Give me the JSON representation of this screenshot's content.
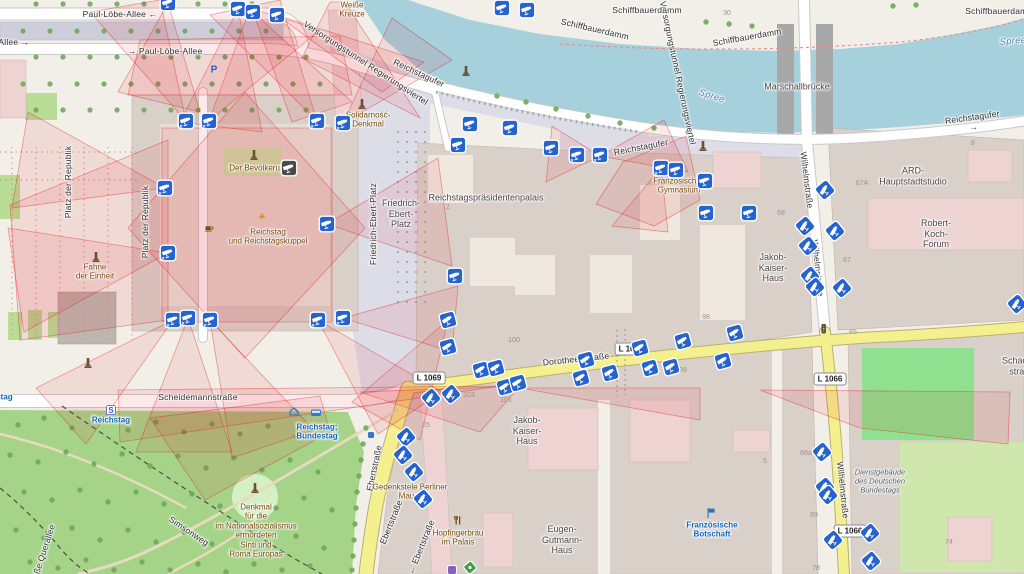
{
  "colors": {
    "camera_blue": "#2563cf",
    "viewshed_red": "#e31a1c",
    "water": "#a6d0dc",
    "park_green": "#a5d488",
    "building_tan": "#d9d0c9",
    "building_pink": "#eed3d3",
    "road_yellow": "#f4f08e",
    "pedestrian": "#dddde8"
  },
  "shields": [
    {
      "t": "L 1069",
      "x": 429,
      "y": 378
    },
    {
      "t": "L 1066",
      "x": 631,
      "y": 349
    },
    {
      "t": "L 1066",
      "x": 830,
      "y": 379
    },
    {
      "t": "L 1066",
      "x": 850,
      "y": 531
    }
  ],
  "labels": [
    {
      "t": "Paul-Löbe-Allee  ←",
      "x": 120,
      "y": 14,
      "cls": "st"
    },
    {
      "t": "Allee  →",
      "x": 14,
      "y": 42,
      "cls": "st"
    },
    {
      "t": "→  Paul-Löbe-Allee",
      "x": 165,
      "y": 51,
      "cls": "st"
    },
    {
      "t": "Versorgungstunnel Regierungsviertel",
      "x": 366,
      "y": 63,
      "rot": 33,
      "cls": "st"
    },
    {
      "t": "Versorgungstunnel Regierungsviertel",
      "x": 678,
      "y": 73,
      "rot": 78,
      "cls": "st"
    },
    {
      "t": "Schiffbauerdamm",
      "x": 647,
      "y": 10,
      "cls": "st"
    },
    {
      "t": "Schiffbauerdamm",
      "x": 595,
      "y": 29,
      "rot": 13,
      "cls": "st"
    },
    {
      "t": "Schiffbauerdamm",
      "x": 747,
      "y": 37,
      "rot": -10,
      "cls": "st"
    },
    {
      "t": "Schiffbauerdamm",
      "x": 1000,
      "y": 11,
      "cls": "st"
    },
    {
      "t": "Reichstagufer",
      "x": 419,
      "y": 73,
      "rot": 25,
      "cls": "st"
    },
    {
      "t": "Reichstagufer",
      "x": 641,
      "y": 147,
      "rot": -11,
      "cls": "st"
    },
    {
      "t": "Reichstagufer  →",
      "x": 973,
      "y": 122,
      "rot": -8,
      "cls": "st"
    },
    {
      "t": "Marschallbrücke",
      "x": 797,
      "y": 87,
      "cls": "pl"
    },
    {
      "t": "Platz der Republik",
      "x": 68,
      "y": 182,
      "rot": -90,
      "cls": "st"
    },
    {
      "t": "Platz der Republik",
      "x": 145,
      "y": 222,
      "rot": -90,
      "cls": "st"
    },
    {
      "t": "Friedrich-Ebert-Platz",
      "x": 373,
      "y": 224,
      "rot": -90,
      "cls": "st"
    },
    {
      "t": "Scheidemannstraße",
      "x": 198,
      "y": 397,
      "cls": "st"
    },
    {
      "t": "Dorotheenstraße",
      "x": 576,
      "y": 359,
      "rot": -6,
      "cls": "st"
    },
    {
      "t": "Ebertstraße",
      "x": 374,
      "y": 468,
      "rot": -78,
      "cls": "st"
    },
    {
      "t": "Ebertstraße",
      "x": 391,
      "y": 522,
      "rot": -68,
      "cls": "st"
    },
    {
      "t": "←  Ebertstraße",
      "x": 421,
      "y": 547,
      "rot": -68,
      "cls": "st"
    },
    {
      "t": "Wilhelmstraße",
      "x": 807,
      "y": 180,
      "rot": 83,
      "cls": "st"
    },
    {
      "t": "Wilhelmstraße",
      "x": 818,
      "y": 268,
      "rot": 84,
      "cls": "st"
    },
    {
      "t": "Wilhelmstraße",
      "x": 843,
      "y": 490,
      "rot": 84,
      "cls": "st"
    },
    {
      "t": "Simsonweg",
      "x": 189,
      "y": 531,
      "rot": 34,
      "cls": "st"
    },
    {
      "t": "Große Querallee",
      "x": 42,
      "y": 556,
      "rot": -72,
      "cls": "st"
    },
    {
      "t": "Reichstagspräsidentenpalais",
      "x": 486,
      "y": 198,
      "cls": "pl"
    },
    {
      "t": "Jakob-\nKaiser-\nHaus",
      "x": 773,
      "y": 268,
      "cls": "pl"
    },
    {
      "t": "Jakob-\nKaiser-\nHaus",
      "x": 527,
      "y": 431,
      "cls": "pl"
    },
    {
      "t": "Eugen-\nGutmann-\nHaus",
      "x": 562,
      "y": 540,
      "cls": "pl"
    },
    {
      "t": "ARD-\nHauptstadtstudio",
      "x": 913,
      "y": 176,
      "cls": "pl"
    },
    {
      "t": "Robert-\nKoch-\nForum",
      "x": 936,
      "y": 234,
      "cls": "pl"
    },
    {
      "t": "Friedrich-\nEbert-\nPlatz",
      "x": 401,
      "y": 214,
      "cls": "pl"
    },
    {
      "t": "Schadow-\nstraße",
      "x": 1022,
      "y": 366,
      "cls": "pl"
    },
    {
      "t": "Weiße\nKreuze",
      "x": 352,
      "y": 10,
      "cls": "poi"
    },
    {
      "t": "Solidarność-\nDenkmal",
      "x": 368,
      "y": 120,
      "cls": "poi"
    },
    {
      "t": "Fahne\nder Einheit",
      "x": 95,
      "y": 272,
      "cls": "poi"
    },
    {
      "t": "Der Bevölkerung",
      "x": 259,
      "y": 168,
      "cls": "poi"
    },
    {
      "t": "Reichstag\nund Reichstagskuppel",
      "x": 268,
      "y": 237,
      "cls": "poi"
    },
    {
      "t": "Französisches\nGymnasium",
      "x": 679,
      "y": 186,
      "cls": "poi"
    },
    {
      "t": "Denkmal\nfür die\nim Nationalsozialismus\nermordeten\nSinti und\nRoma Europas",
      "x": 256,
      "y": 531,
      "cls": "poi"
    },
    {
      "t": "Hopfingerbräu\nim Palais",
      "x": 458,
      "y": 538,
      "cls": "poi"
    },
    {
      "t": "Gedenkstele Berliner\nMauer",
      "x": 410,
      "y": 492,
      "cls": "poi"
    },
    {
      "t": "Reichstag",
      "x": 111,
      "y": 420,
      "cls": "tr"
    },
    {
      "t": "Reichstag;\nBundestag",
      "x": 317,
      "y": 432,
      "cls": "tr"
    },
    {
      "t": "Französische\nBotschaft",
      "x": 712,
      "y": 530,
      "cls": "tr"
    },
    {
      "t": "Bundestag",
      "x": -8,
      "y": 397,
      "cls": "tr"
    },
    {
      "t": "Spree",
      "x": 712,
      "y": 96,
      "rot": 18,
      "cls": "wa"
    },
    {
      "t": "Spree",
      "x": 1013,
      "y": 41,
      "rot": -5,
      "cls": "wa"
    },
    {
      "t": "Dienstgebäude\ndes Deutschen\nBundestags",
      "x": 880,
      "y": 482,
      "cls": "ad"
    },
    {
      "t": "30",
      "x": 727,
      "y": 14,
      "cls": "hn"
    },
    {
      "t": "2",
      "x": 448,
      "y": 208,
      "cls": "hn"
    },
    {
      "t": "100",
      "x": 514,
      "y": 341,
      "cls": "hn"
    },
    {
      "t": "98",
      "x": 706,
      "y": 318,
      "cls": "hn"
    },
    {
      "t": "99",
      "x": 683,
      "y": 371,
      "cls": "hn"
    },
    {
      "t": "103",
      "x": 469,
      "y": 396,
      "cls": "hn"
    },
    {
      "t": "101",
      "x": 506,
      "y": 401,
      "cls": "hn"
    },
    {
      "t": "25",
      "x": 426,
      "y": 426,
      "cls": "hn"
    },
    {
      "t": "65",
      "x": 853,
      "y": 333,
      "cls": "hn"
    },
    {
      "t": "67A",
      "x": 862,
      "y": 184,
      "cls": "hn"
    },
    {
      "t": "67",
      "x": 847,
      "y": 261,
      "cls": "hn"
    },
    {
      "t": "68",
      "x": 781,
      "y": 214,
      "cls": "hn"
    },
    {
      "t": "8",
      "x": 973,
      "y": 144,
      "cls": "hn"
    },
    {
      "t": "68a",
      "x": 806,
      "y": 454,
      "cls": "hn"
    },
    {
      "t": "69",
      "x": 814,
      "y": 516,
      "cls": "hn"
    },
    {
      "t": "78",
      "x": 816,
      "y": 569,
      "cls": "hn"
    },
    {
      "t": "74",
      "x": 949,
      "y": 543,
      "cls": "hn"
    },
    {
      "t": "5",
      "x": 765,
      "y": 462,
      "cls": "hn"
    }
  ],
  "cameras": [
    {
      "x": 168,
      "y": 3
    },
    {
      "x": 238,
      "y": 9
    },
    {
      "x": 253,
      "y": 12
    },
    {
      "x": 277,
      "y": 15
    },
    {
      "x": 502,
      "y": 8
    },
    {
      "x": 527,
      "y": 10
    },
    {
      "x": 186,
      "y": 121,
      "b": 1
    },
    {
      "x": 209,
      "y": 121,
      "b": 1
    },
    {
      "x": 317,
      "y": 121,
      "b": 1
    },
    {
      "x": 343,
      "y": 123,
      "b": 1
    },
    {
      "x": 165,
      "y": 188,
      "b": 1
    },
    {
      "x": 168,
      "y": 253,
      "b": 1
    },
    {
      "x": 327,
      "y": 224
    },
    {
      "x": 173,
      "y": 320,
      "b": 1
    },
    {
      "x": 188,
      "y": 318,
      "b": 1
    },
    {
      "x": 210,
      "y": 320,
      "b": 1
    },
    {
      "x": 318,
      "y": 320,
      "b": 1
    },
    {
      "x": 343,
      "y": 318,
      "b": 1
    },
    {
      "x": 289,
      "y": 168,
      "d": 1
    },
    {
      "x": 470,
      "y": 124
    },
    {
      "x": 510,
      "y": 128
    },
    {
      "x": 458,
      "y": 145
    },
    {
      "x": 551,
      "y": 148
    },
    {
      "x": 577,
      "y": 155,
      "b": 1
    },
    {
      "x": 600,
      "y": 155,
      "b": 1
    },
    {
      "x": 661,
      "y": 168,
      "b": 1
    },
    {
      "x": 676,
      "y": 170
    },
    {
      "x": 705,
      "y": 181
    },
    {
      "x": 455,
      "y": 276
    },
    {
      "x": 706,
      "y": 213
    },
    {
      "x": 749,
      "y": 213
    },
    {
      "x": 448,
      "y": 320,
      "r": -15
    },
    {
      "x": 448,
      "y": 347,
      "r": -15
    },
    {
      "x": 481,
      "y": 370,
      "r": -15
    },
    {
      "x": 496,
      "y": 368,
      "r": -15
    },
    {
      "x": 505,
      "y": 387,
      "r": -15
    },
    {
      "x": 518,
      "y": 383,
      "r": -15
    },
    {
      "x": 586,
      "y": 360,
      "r": -15
    },
    {
      "x": 581,
      "y": 378,
      "r": -15
    },
    {
      "x": 610,
      "y": 373,
      "r": -15
    },
    {
      "x": 640,
      "y": 348,
      "r": -15
    },
    {
      "x": 650,
      "y": 368,
      "r": -15
    },
    {
      "x": 671,
      "y": 367,
      "r": -15
    },
    {
      "x": 683,
      "y": 341,
      "r": -15
    },
    {
      "x": 723,
      "y": 361,
      "r": -15
    },
    {
      "x": 735,
      "y": 333,
      "r": -15
    },
    {
      "x": 431,
      "y": 398,
      "r": -40
    },
    {
      "x": 451,
      "y": 394,
      "r": -40
    },
    {
      "x": 406,
      "y": 437,
      "r": -40
    },
    {
      "x": 403,
      "y": 455,
      "r": -40
    },
    {
      "x": 414,
      "y": 472,
      "r": -40
    },
    {
      "x": 423,
      "y": 499,
      "r": -40
    },
    {
      "x": 825,
      "y": 190,
      "r": -40
    },
    {
      "x": 805,
      "y": 226,
      "r": -40
    },
    {
      "x": 835,
      "y": 231,
      "r": -40
    },
    {
      "x": 808,
      "y": 246,
      "r": -40
    },
    {
      "x": 810,
      "y": 276,
      "r": -40
    },
    {
      "x": 815,
      "y": 287,
      "r": -40
    },
    {
      "x": 842,
      "y": 288,
      "r": -40
    },
    {
      "x": 1017,
      "y": 304,
      "r": -40
    },
    {
      "x": 822,
      "y": 452,
      "r": -40
    },
    {
      "x": 825,
      "y": 487,
      "r": -40
    },
    {
      "x": 828,
      "y": 495,
      "r": -40
    },
    {
      "x": 833,
      "y": 540,
      "r": -40
    },
    {
      "x": 870,
      "y": 533,
      "r": -40
    },
    {
      "x": 871,
      "y": 561,
      "r": -40
    }
  ],
  "pois": [
    {
      "k": "memorial",
      "x": 362,
      "y": 106
    },
    {
      "k": "memorial",
      "x": 96,
      "y": 259
    },
    {
      "k": "memorial",
      "x": 88,
      "y": 365
    },
    {
      "k": "memorial",
      "x": 255,
      "y": 490
    },
    {
      "k": "memorial",
      "x": 703,
      "y": 148
    },
    {
      "k": "memorial",
      "x": 466,
      "y": 73
    },
    {
      "k": "memorial",
      "x": 254,
      "y": 157
    },
    {
      "k": "restaurant",
      "x": 458,
      "y": 521
    },
    {
      "k": "cafe",
      "x": 209,
      "y": 228
    },
    {
      "k": "flag",
      "x": 711,
      "y": 514
    },
    {
      "k": "sbahn",
      "x": 111,
      "y": 411
    },
    {
      "k": "home",
      "x": 294,
      "y": 412
    },
    {
      "k": "bus",
      "x": 316,
      "y": 413
    },
    {
      "k": "parking",
      "x": 214,
      "y": 70
    },
    {
      "k": "asterisk",
      "x": 262,
      "y": 217
    },
    {
      "k": "trafficlight",
      "x": 824,
      "y": 330
    },
    {
      "k": "stop",
      "x": 371,
      "y": 434
    },
    {
      "k": "recycle",
      "x": 470,
      "y": 570
    },
    {
      "k": "purple",
      "x": 452,
      "y": 571
    }
  ],
  "viewsheds": [
    "186,121 90,12 160,0",
    "209,121 250,8 320,30",
    "317,121 210,15 280,0",
    "343,123 392,18 452,60",
    "165,188 28,112 12,208",
    "168,253 8,228 24,332",
    "327,224 438,158 452,266",
    "173,320 36,388 86,444",
    "188,318 136,452 232,452",
    "210,320 232,458 314,430",
    "318,320 378,434 442,392",
    "343,318 452,352 458,286",
    "238,9 180,122 262,132",
    "253,12 292,122 352,102",
    "277,15 382,92 424,62",
    "168,3 118,92 200,112",
    "245,92 365,228 245,358 128,228",
    "162,128 332,128 332,322 162,322",
    "128,95 352,95 340,36 140,40",
    "10,205 168,140 168,320 20,340",
    "500,386 118,390 120,442",
    "320,396 150,418 205,500 330,432",
    "448,320 352,402 420,440",
    "600,156 552,126 546,182",
    "600,156 664,120 688,172",
    "623,162 686,136 700,200 654,226 596,204",
    "661,168 612,226 668,232",
    "345,2 420,118 302,58 330,2",
    "520,388 700,388 700,420",
    "760,390 1010,392 1008,444 860,428",
    "360,392 520,386 480,432"
  ],
  "trees": {
    "rows": [
      {
        "y": 4,
        "x0": 36,
        "dx": 27,
        "n": 9
      },
      {
        "y": 31,
        "x0": 23,
        "dx": 27,
        "n": 10
      },
      {
        "y": 57,
        "x0": 36,
        "dx": 27,
        "n": 11
      },
      {
        "y": 84,
        "x0": 23,
        "dx": 27,
        "n": 12
      },
      {
        "y": 110,
        "x0": 36,
        "dx": 27,
        "n": 11
      }
    ],
    "points": [
      [
        497,
        96
      ],
      [
        526,
        102
      ],
      [
        556,
        109
      ],
      [
        588,
        116
      ],
      [
        620,
        123
      ],
      [
        654,
        128
      ],
      [
        688,
        132
      ],
      [
        706,
        22
      ],
      [
        729,
        24
      ],
      [
        752,
        26
      ],
      [
        893,
        6
      ],
      [
        916,
        5
      ],
      [
        18,
        425
      ],
      [
        44,
        418
      ],
      [
        72,
        428
      ],
      [
        100,
        420
      ],
      [
        128,
        430
      ],
      [
        156,
        422
      ],
      [
        184,
        432
      ],
      [
        212,
        424
      ],
      [
        240,
        434
      ],
      [
        268,
        426
      ],
      [
        296,
        436
      ],
      [
        324,
        428
      ],
      [
        10,
        455
      ],
      [
        38,
        462
      ],
      [
        66,
        452
      ],
      [
        94,
        464
      ],
      [
        122,
        454
      ],
      [
        150,
        466
      ],
      [
        178,
        456
      ],
      [
        206,
        468
      ],
      [
        234,
        458
      ],
      [
        262,
        470
      ],
      [
        290,
        460
      ],
      [
        318,
        472
      ],
      [
        24,
        492
      ],
      [
        52,
        500
      ],
      [
        80,
        490
      ],
      [
        108,
        502
      ],
      [
        136,
        492
      ],
      [
        164,
        504
      ],
      [
        192,
        494
      ],
      [
        220,
        506
      ],
      [
        276,
        508
      ],
      [
        304,
        498
      ],
      [
        332,
        510
      ],
      [
        16,
        530
      ],
      [
        44,
        538
      ],
      [
        72,
        528
      ],
      [
        100,
        540
      ],
      [
        128,
        530
      ],
      [
        156,
        542
      ],
      [
        184,
        532
      ],
      [
        212,
        544
      ],
      [
        240,
        534
      ],
      [
        268,
        546
      ],
      [
        296,
        536
      ],
      [
        324,
        548
      ],
      [
        30,
        562
      ],
      [
        58,
        568
      ],
      [
        86,
        560
      ],
      [
        114,
        570
      ],
      [
        142,
        562
      ],
      [
        170,
        570
      ],
      [
        198,
        564
      ],
      [
        226,
        572
      ],
      [
        254,
        564
      ],
      [
        282,
        570
      ],
      [
        310,
        566
      ],
      [
        366,
        428
      ],
      [
        363,
        444
      ],
      [
        361,
        460
      ],
      [
        359,
        476
      ],
      [
        357,
        492
      ],
      [
        356,
        508
      ],
      [
        355,
        524
      ],
      [
        354,
        540
      ],
      [
        353,
        556
      ],
      [
        352,
        570
      ]
    ]
  }
}
